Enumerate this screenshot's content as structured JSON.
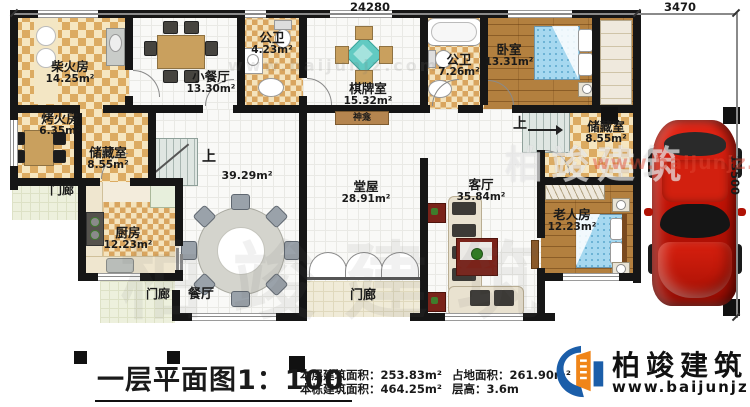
{
  "dimensions": {
    "top": "24280",
    "top_right": "3470",
    "right": "13500"
  },
  "rooms": {
    "chai": {
      "name": "柴火房",
      "area": "14.25m²"
    },
    "xiaocanting": {
      "name": "小餐厅",
      "area": "13.30m²"
    },
    "gongwei1": {
      "name": "公卫",
      "area": "4.23m²"
    },
    "qipai": {
      "name": "棋牌室",
      "area": "15.32m²"
    },
    "gongwei2": {
      "name": "公卫",
      "area": "7.26m²"
    },
    "woshi": {
      "name": "卧室",
      "area": "13.31m²"
    },
    "kaohuo": {
      "name": "烤火房",
      "area": "6.35m²"
    },
    "chucang_left": {
      "name": "储藏室",
      "area": "8.55m²"
    },
    "chucang_right": {
      "name": "储藏室",
      "area": "8.55m²"
    },
    "chufang": {
      "name": "厨房",
      "area": "12.23m²"
    },
    "laoren": {
      "name": "老人房",
      "area": "12.23m²"
    },
    "tangwu": {
      "name": "堂屋",
      "area": "28.91m²"
    },
    "keting": {
      "name": "客厅",
      "area": "35.84m²"
    },
    "canting": {
      "name": "餐厅"
    },
    "open_area": {
      "area": "39.29m²"
    },
    "shenkan": {
      "name": "神龛"
    },
    "menlang1": {
      "name": "门廊"
    },
    "menlang2": {
      "name": "门廊"
    },
    "menlang3": {
      "name": "门廊"
    },
    "stairs_up_left": {
      "label": "上"
    },
    "stairs_up_right": {
      "label": "上"
    }
  },
  "footer": {
    "title": "一层平面图1：100",
    "stats": [
      "本层建筑面积：253.83m²",
      "本栋建筑面积：464.25m²",
      "占地面积：261.90m²",
      "层高：3.6m"
    ],
    "brand": {
      "name": "柏竣建筑",
      "url": "www.baijunjz.com"
    }
  },
  "watermark": {
    "text": "柏竣建筑",
    "url": "www.baijunjz.com"
  },
  "colors": {
    "accent_blue": "#1b5ea9",
    "accent_orange": "#f08519",
    "car_red": "#c01205"
  }
}
